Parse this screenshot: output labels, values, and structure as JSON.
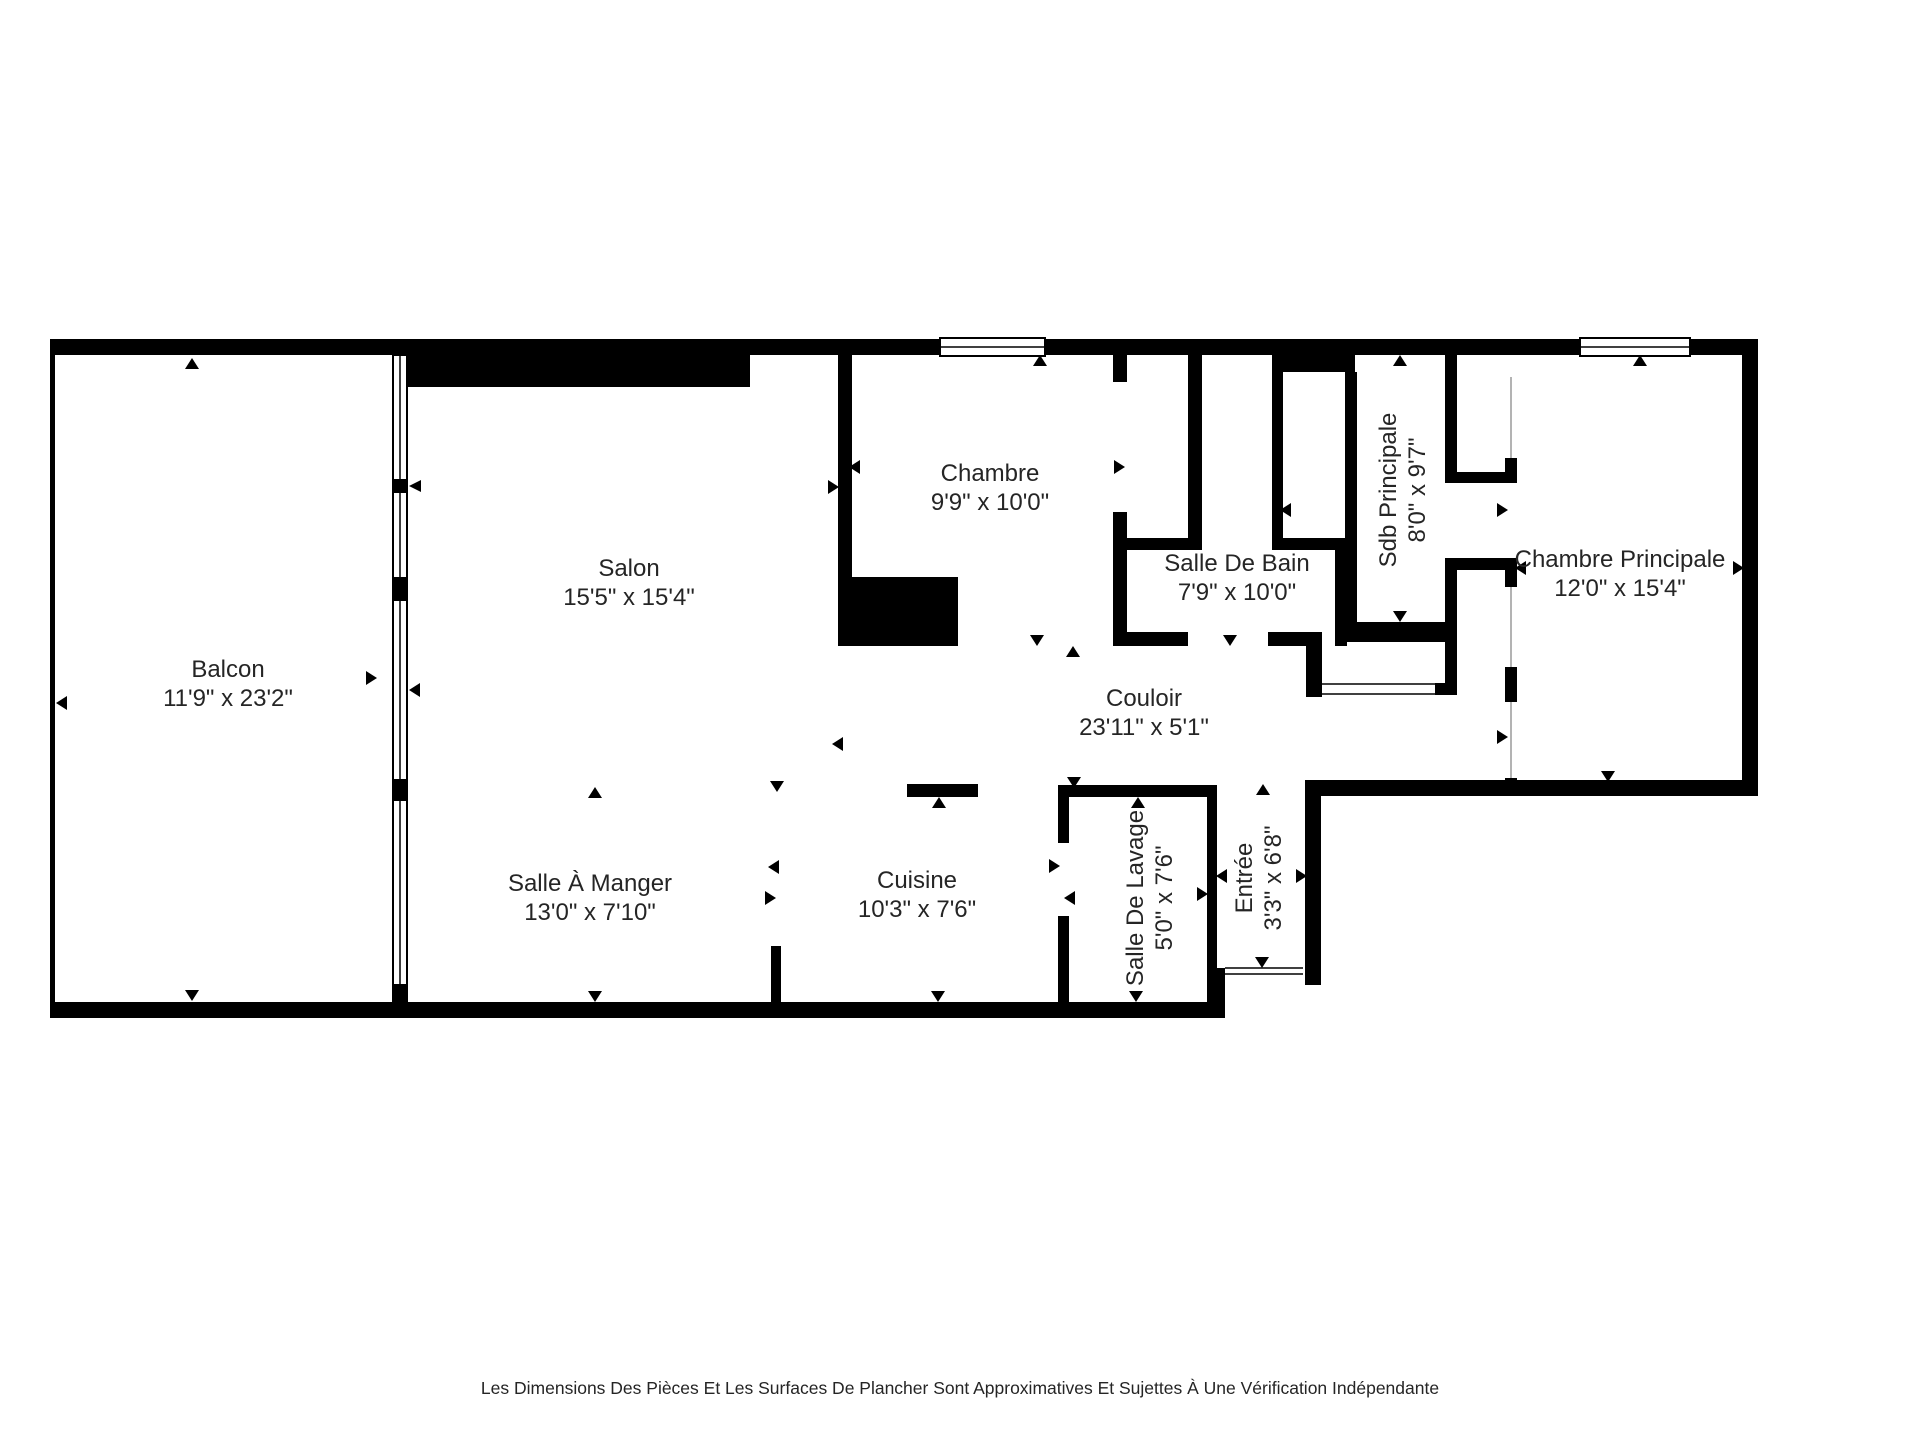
{
  "colors": {
    "wall": "#000000",
    "background": "#ffffff",
    "label_text": "#252525",
    "door_line": "#b3b3b3"
  },
  "disclaimer": "Les Dimensions Des Pièces Et Les Surfaces De Plancher Sont Approximatives Et Sujettes À Une Vérification Indépendante",
  "rooms": [
    {
      "id": "balcon",
      "name": "Balcon",
      "dims": "11'9\" x 23'2\"",
      "x": 228,
      "y": 685,
      "rotated": false
    },
    {
      "id": "salon",
      "name": "Salon",
      "dims": "15'5\" x 15'4\"",
      "x": 629,
      "y": 584,
      "rotated": false
    },
    {
      "id": "salle-a-manger",
      "name": "Salle À Manger",
      "dims": "13'0\" x 7'10\"",
      "x": 590,
      "y": 899,
      "rotated": false
    },
    {
      "id": "cuisine",
      "name": "Cuisine",
      "dims": "10'3\" x 7'6\"",
      "x": 917,
      "y": 896,
      "rotated": false
    },
    {
      "id": "chambre",
      "name": "Chambre",
      "dims": "9'9\" x 10'0\"",
      "x": 990,
      "y": 489,
      "rotated": false
    },
    {
      "id": "salle-de-bain",
      "name": "Salle De Bain",
      "dims": "7'9\" x 10'0\"",
      "x": 1237,
      "y": 579,
      "rotated": false
    },
    {
      "id": "sdb-principale",
      "name": "Sdb Principale",
      "dims": "8'0\" x 9'7\"",
      "x": 1404,
      "y": 490,
      "rotated": true
    },
    {
      "id": "chambre-principale",
      "name": "Chambre Principale",
      "dims": "12'0\" x 15'4\"",
      "x": 1620,
      "y": 575,
      "rotated": false
    },
    {
      "id": "couloir",
      "name": "Couloir",
      "dims": "23'11\" x 5'1\"",
      "x": 1144,
      "y": 714,
      "rotated": false
    },
    {
      "id": "salle-de-lavage",
      "name": "Salle De Lavage",
      "dims": "5'0\" x 7'6\"",
      "x": 1151,
      "y": 898,
      "rotated": true
    },
    {
      "id": "entree",
      "name": "Entrée",
      "dims": "3'3\" x 6'8\"",
      "x": 1260,
      "y": 878,
      "rotated": true
    }
  ],
  "ticks": [
    {
      "dir": "up",
      "x": 192,
      "y": 364
    },
    {
      "dir": "left",
      "x": 62,
      "y": 703
    },
    {
      "dir": "right",
      "x": 371,
      "y": 678
    },
    {
      "dir": "left",
      "x": 415,
      "y": 690
    },
    {
      "dir": "down",
      "x": 192,
      "y": 995
    },
    {
      "dir": "up",
      "x": 595,
      "y": 793
    },
    {
      "dir": "down",
      "x": 777,
      "y": 786
    },
    {
      "dir": "down",
      "x": 595,
      "y": 996
    },
    {
      "dir": "down",
      "x": 938,
      "y": 996
    },
    {
      "dir": "up",
      "x": 939,
      "y": 803
    },
    {
      "dir": "left",
      "x": 774,
      "y": 867
    },
    {
      "dir": "right",
      "x": 770,
      "y": 898
    },
    {
      "dir": "left",
      "x": 855,
      "y": 467
    },
    {
      "dir": "right",
      "x": 833,
      "y": 487
    },
    {
      "dir": "up",
      "x": 1040,
      "y": 361
    },
    {
      "dir": "down",
      "x": 1037,
      "y": 640
    },
    {
      "dir": "up",
      "x": 1073,
      "y": 652
    },
    {
      "dir": "right",
      "x": 1119,
      "y": 467
    },
    {
      "dir": "left",
      "x": 1286,
      "y": 510
    },
    {
      "dir": "down",
      "x": 1230,
      "y": 640
    },
    {
      "dir": "right",
      "x": 1348,
      "y": 588
    },
    {
      "dir": "up",
      "x": 1400,
      "y": 361
    },
    {
      "dir": "down",
      "x": 1400,
      "y": 616
    },
    {
      "dir": "right",
      "x": 1502,
      "y": 510
    },
    {
      "dir": "left",
      "x": 1521,
      "y": 568
    },
    {
      "dir": "right",
      "x": 1502,
      "y": 737
    },
    {
      "dir": "left",
      "x": 838,
      "y": 744
    },
    {
      "dir": "up",
      "x": 1640,
      "y": 361
    },
    {
      "dir": "right",
      "x": 1738,
      "y": 568
    },
    {
      "dir": "down",
      "x": 1608,
      "y": 776
    },
    {
      "dir": "down",
      "x": 1074,
      "y": 782
    },
    {
      "dir": "up",
      "x": 1138,
      "y": 803
    },
    {
      "dir": "right",
      "x": 1054,
      "y": 866
    },
    {
      "dir": "left",
      "x": 1070,
      "y": 898
    },
    {
      "dir": "right",
      "x": 1202,
      "y": 894
    },
    {
      "dir": "down",
      "x": 1136,
      "y": 996
    },
    {
      "dir": "up",
      "x": 1263,
      "y": 790
    },
    {
      "dir": "left",
      "x": 1222,
      "y": 876
    },
    {
      "dir": "right",
      "x": 1301,
      "y": 876
    },
    {
      "dir": "down",
      "x": 1262,
      "y": 962
    }
  ]
}
